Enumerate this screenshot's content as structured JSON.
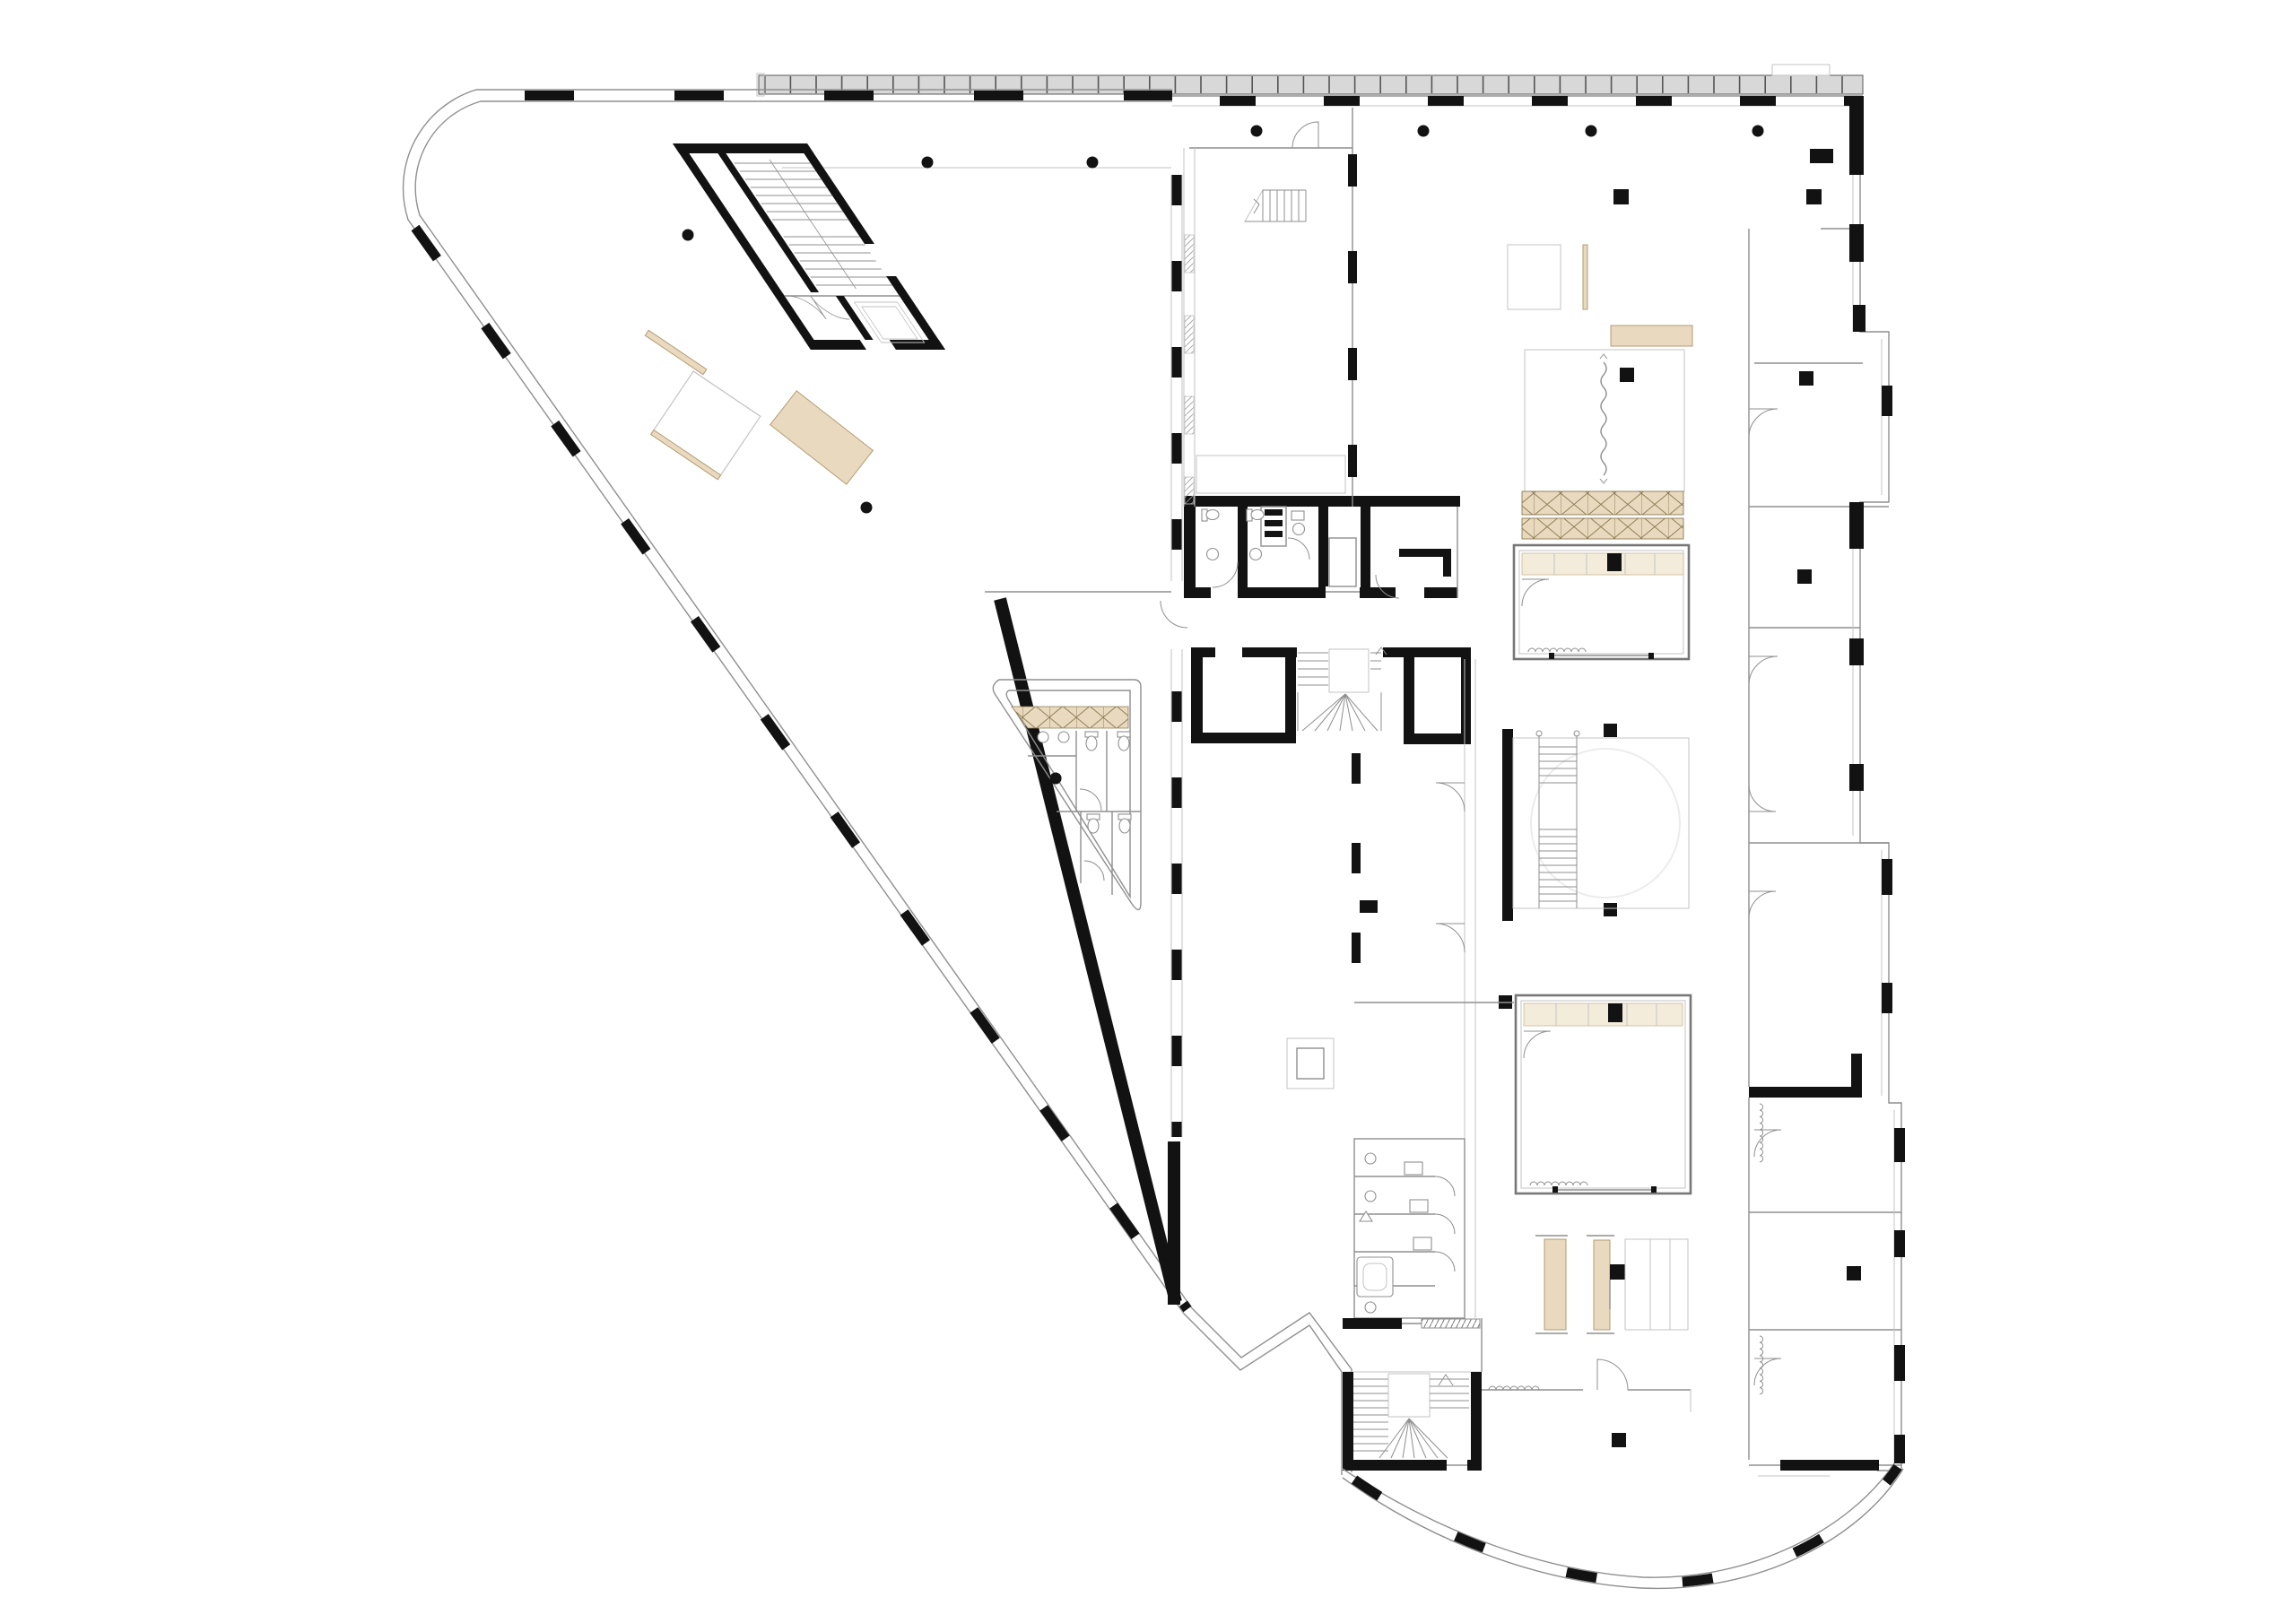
{
  "document": {
    "type": "architectural-floor-plan",
    "visible_text": [],
    "notes": "line drawing only, no labels or dimensions visible"
  },
  "colors": {
    "bg": "#ffffff",
    "wall": "#121212",
    "line": "#8f8f8f",
    "line_light": "#c3c3c3",
    "faint": "#e9e9e9",
    "band": "#d8d8d8",
    "band_stroke": "#5a5a5a",
    "tan": "#e8d9bf",
    "tan_stroke": "#b49c74",
    "tan_light": "#f3ecdb",
    "tan_stroke2": "#cbb893",
    "hatch": "#8d7b52",
    "circle_faint": "#ececec"
  },
  "plan": {
    "wings": [
      {
        "name": "left-triangular-wing",
        "features": [
          "rounded-north-west-corner",
          "glazed-facades-with-mullions",
          "rotated-stair-elevator-core",
          "tan-furniture-group",
          "triangular-wc-block",
          "heavy-diagonal-wall",
          "round-columns"
        ]
      },
      {
        "name": "right-rectangular-wing",
        "features": [
          "north-facade-band",
          "open-plan-space",
          "narrow-room-with-small-stair",
          "central-open-stair",
          "meeting-box-room-upper",
          "meeting-box-room-lower",
          "crossed-hatch-bench-band",
          "squiggle-feature-room",
          "south-wc-block",
          "stage-furniture-group",
          "south-stair-core",
          "curved-south-facade",
          "stepped-east-facade",
          "square-columns"
        ]
      }
    ],
    "core": {
      "name": "central-service-core",
      "features": [
        "wc-rooms",
        "service-shaft",
        "elevator",
        "corridor",
        "u-shaped-main-stair",
        "secondary-shafts"
      ]
    }
  }
}
